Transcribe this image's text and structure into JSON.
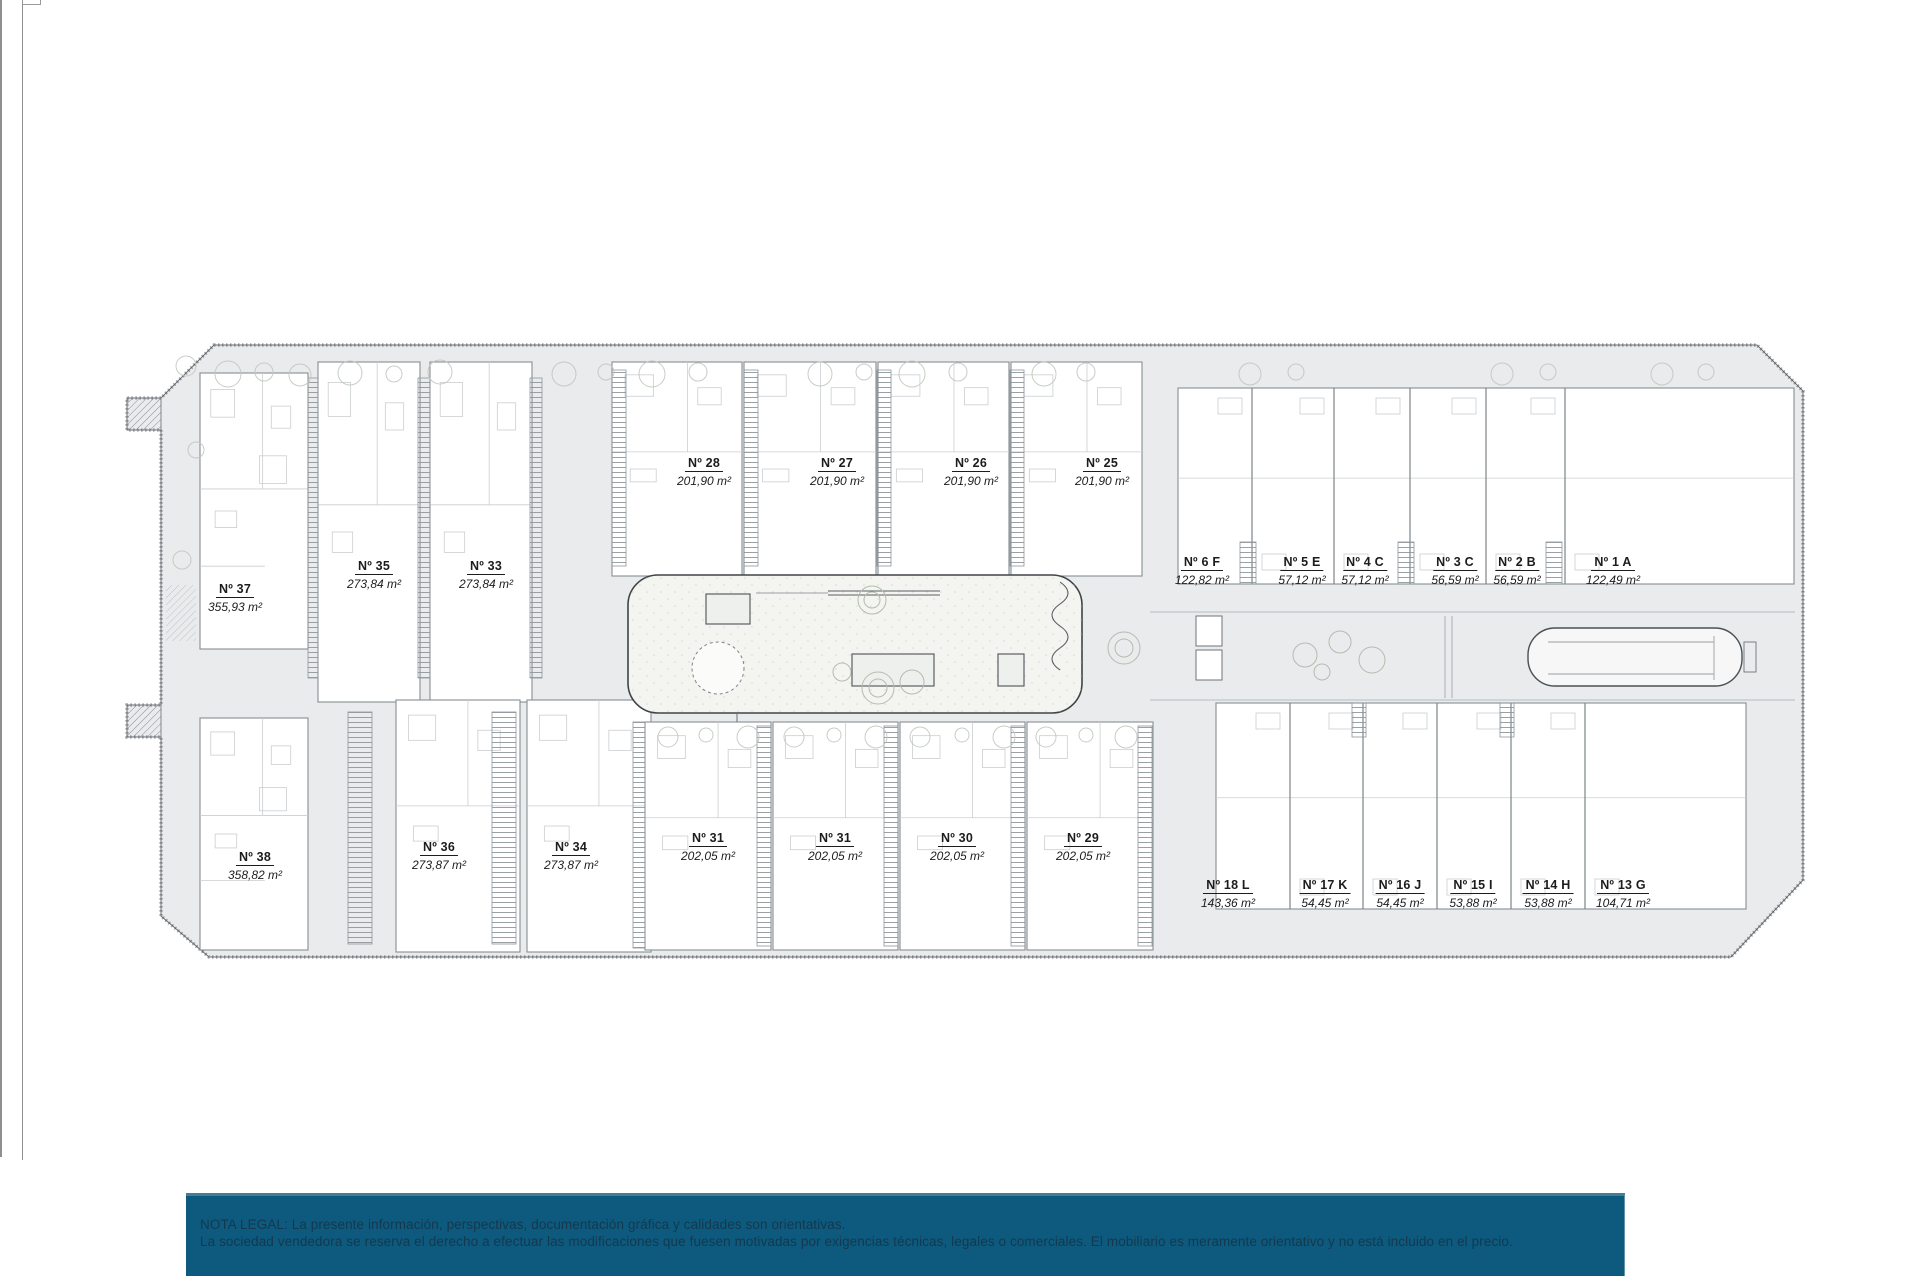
{
  "colors": {
    "site_fill": "#e9ebec",
    "site_outline": "#6a6f73",
    "legal_bar_bg": "#0d5a7e",
    "legal_text": "#14384e"
  },
  "legal": {
    "line1": "NOTA LEGAL: La presente información, perspectivas, documentación gráfica y calidades son orientativas.",
    "line2": "La sociedad vendedora se reserva el derecho a efectuar las modificaciones que fuesen motivadas por exigencias técnicas, legales o comerciales. El mobiliario es meramente orientativo y no está incluido en el precio."
  },
  "plan": {
    "units": [
      {
        "number": "Nº 37",
        "area": "355,93 m²",
        "x": 235,
        "y": 580
      },
      {
        "number": "Nº 35",
        "area": "273,84 m²",
        "x": 374,
        "y": 557
      },
      {
        "number": "Nº 33",
        "area": "273,84 m²",
        "x": 486,
        "y": 557
      },
      {
        "number": "Nº 28",
        "area": "201,90 m²",
        "x": 704,
        "y": 454
      },
      {
        "number": "Nº 27",
        "area": "201,90 m²",
        "x": 837,
        "y": 454
      },
      {
        "number": "Nº 26",
        "area": "201,90 m²",
        "x": 971,
        "y": 454
      },
      {
        "number": "Nº 25",
        "area": "201,90 m²",
        "x": 1102,
        "y": 454
      },
      {
        "number": "Nº 6 F",
        "area": "122,82 m²",
        "x": 1202,
        "y": 553
      },
      {
        "number": "Nº 5 E",
        "area": "57,12 m²",
        "x": 1302,
        "y": 553
      },
      {
        "number": "Nº 4 C",
        "area": "57,12 m²",
        "x": 1365,
        "y": 553
      },
      {
        "number": "Nº 3 C",
        "area": "56,59 m²",
        "x": 1455,
        "y": 553
      },
      {
        "number": "Nº 2 B",
        "area": "56,59 m²",
        "x": 1517,
        "y": 553
      },
      {
        "number": "Nº 1 A",
        "area": "122,49 m²",
        "x": 1613,
        "y": 553
      },
      {
        "number": "Nº 38",
        "area": "358,82 m²",
        "x": 255,
        "y": 848
      },
      {
        "number": "Nº 36",
        "area": "273,87 m²",
        "x": 439,
        "y": 838
      },
      {
        "number": "Nº 34",
        "area": "273,87 m²",
        "x": 571,
        "y": 838
      },
      {
        "number": "Nº 31",
        "area": "202,05 m²",
        "x": 708,
        "y": 829
      },
      {
        "number": "Nº 31",
        "area": "202,05 m²",
        "x": 835,
        "y": 829
      },
      {
        "number": "Nº 30",
        "area": "202,05 m²",
        "x": 957,
        "y": 829
      },
      {
        "number": "Nº 29",
        "area": "202,05 m²",
        "x": 1083,
        "y": 829
      },
      {
        "number": "Nº 18 L",
        "area": "143,36 m²",
        "x": 1228,
        "y": 876
      },
      {
        "number": "Nº 17 K",
        "area": "54,45 m²",
        "x": 1325,
        "y": 876
      },
      {
        "number": "Nº 16 J",
        "area": "54,45 m²",
        "x": 1400,
        "y": 876
      },
      {
        "number": "Nº 15 I",
        "area": "53,88 m²",
        "x": 1473,
        "y": 876
      },
      {
        "number": "Nº 14 H",
        "area": "53,88 m²",
        "x": 1548,
        "y": 876
      },
      {
        "number": "Nº 13 G",
        "area": "104,71 m²",
        "x": 1623,
        "y": 876
      }
    ],
    "blocks": [
      {
        "x": 200,
        "y": 373,
        "w": 108,
        "h": 276,
        "type": "villa"
      },
      {
        "x": 318,
        "y": 362,
        "w": 102,
        "h": 340,
        "type": "strip"
      },
      {
        "x": 430,
        "y": 362,
        "w": 102,
        "h": 340,
        "type": "strip"
      },
      {
        "x": 612,
        "y": 362,
        "w": 130,
        "h": 214,
        "type": "strip"
      },
      {
        "x": 744,
        "y": 362,
        "w": 132,
        "h": 214,
        "type": "strip"
      },
      {
        "x": 878,
        "y": 362,
        "w": 131,
        "h": 214,
        "type": "strip"
      },
      {
        "x": 1011,
        "y": 362,
        "w": 131,
        "h": 214,
        "type": "strip"
      },
      {
        "x": 1178,
        "y": 388,
        "w": 616,
        "h": 196,
        "type": "apart",
        "dividers": [
          1252,
          1334,
          1410,
          1486,
          1565
        ]
      },
      {
        "x": 200,
        "y": 718,
        "w": 108,
        "h": 232,
        "type": "villa"
      },
      {
        "x": 396,
        "y": 700,
        "w": 124,
        "h": 252,
        "type": "strip"
      },
      {
        "x": 527,
        "y": 700,
        "w": 124,
        "h": 252,
        "type": "strip"
      },
      {
        "x": 645,
        "y": 722,
        "w": 126,
        "h": 228,
        "type": "strip"
      },
      {
        "x": 773,
        "y": 722,
        "w": 125,
        "h": 228,
        "type": "strip"
      },
      {
        "x": 900,
        "y": 722,
        "w": 125,
        "h": 228,
        "type": "strip"
      },
      {
        "x": 1027,
        "y": 722,
        "w": 126,
        "h": 228,
        "type": "strip"
      },
      {
        "x": 1216,
        "y": 703,
        "w": 530,
        "h": 206,
        "type": "apart",
        "dividers": [
          1290,
          1363,
          1437,
          1511,
          1585
        ]
      }
    ]
  }
}
